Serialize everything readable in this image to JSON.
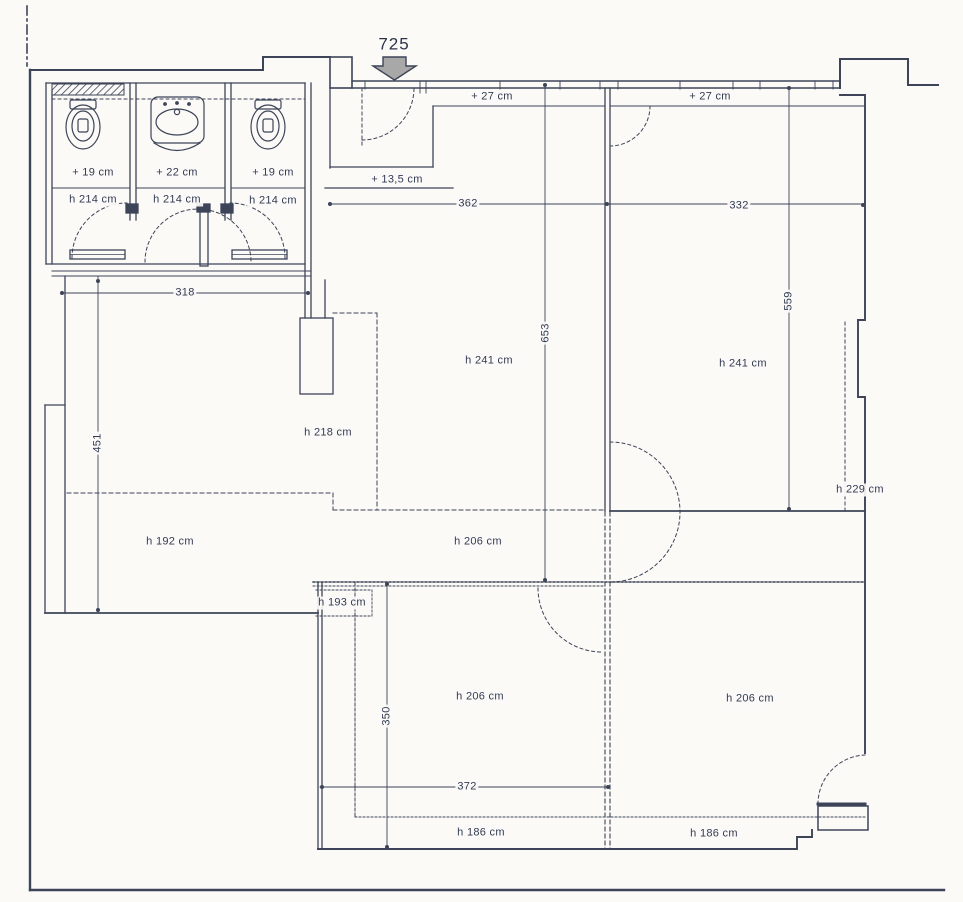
{
  "drawing_type": "floor-plan",
  "colors": {
    "ink": "#3d4458",
    "paper": "#fbfaf7",
    "arrow_fill": "#a8a8a8"
  },
  "labels": {
    "arrow_725": "725",
    "offset_27_left": "+ 27 cm",
    "offset_27_right": "+ 27 cm",
    "offset_19_left": "+ 19 cm",
    "offset_22_mid": "+ 22 cm",
    "offset_19_right": "+ 19 cm",
    "h214_left": "h 214 cm",
    "h214_mid": "h 214 cm",
    "h214_right": "h 214 cm",
    "offset_13_5": "+ 13,5 cm",
    "dim_362": "362",
    "dim_332": "332",
    "dim_318": "318",
    "dim_653": "653",
    "dim_559": "559",
    "dim_451": "451",
    "h241_left": "h 241 cm",
    "h241_right": "h 241 cm",
    "h218": "h 218 cm",
    "h229": "h 229 cm",
    "h192": "h 192 cm",
    "h206_mid": "h 206 cm",
    "h193": "h 193 cm",
    "h206_bottom_left": "h 206 cm",
    "h206_bottom_right": "h 206 cm",
    "dim_350": "350",
    "dim_372": "372",
    "h186_left": "h 186 cm",
    "h186_right": "h 186 cm"
  }
}
